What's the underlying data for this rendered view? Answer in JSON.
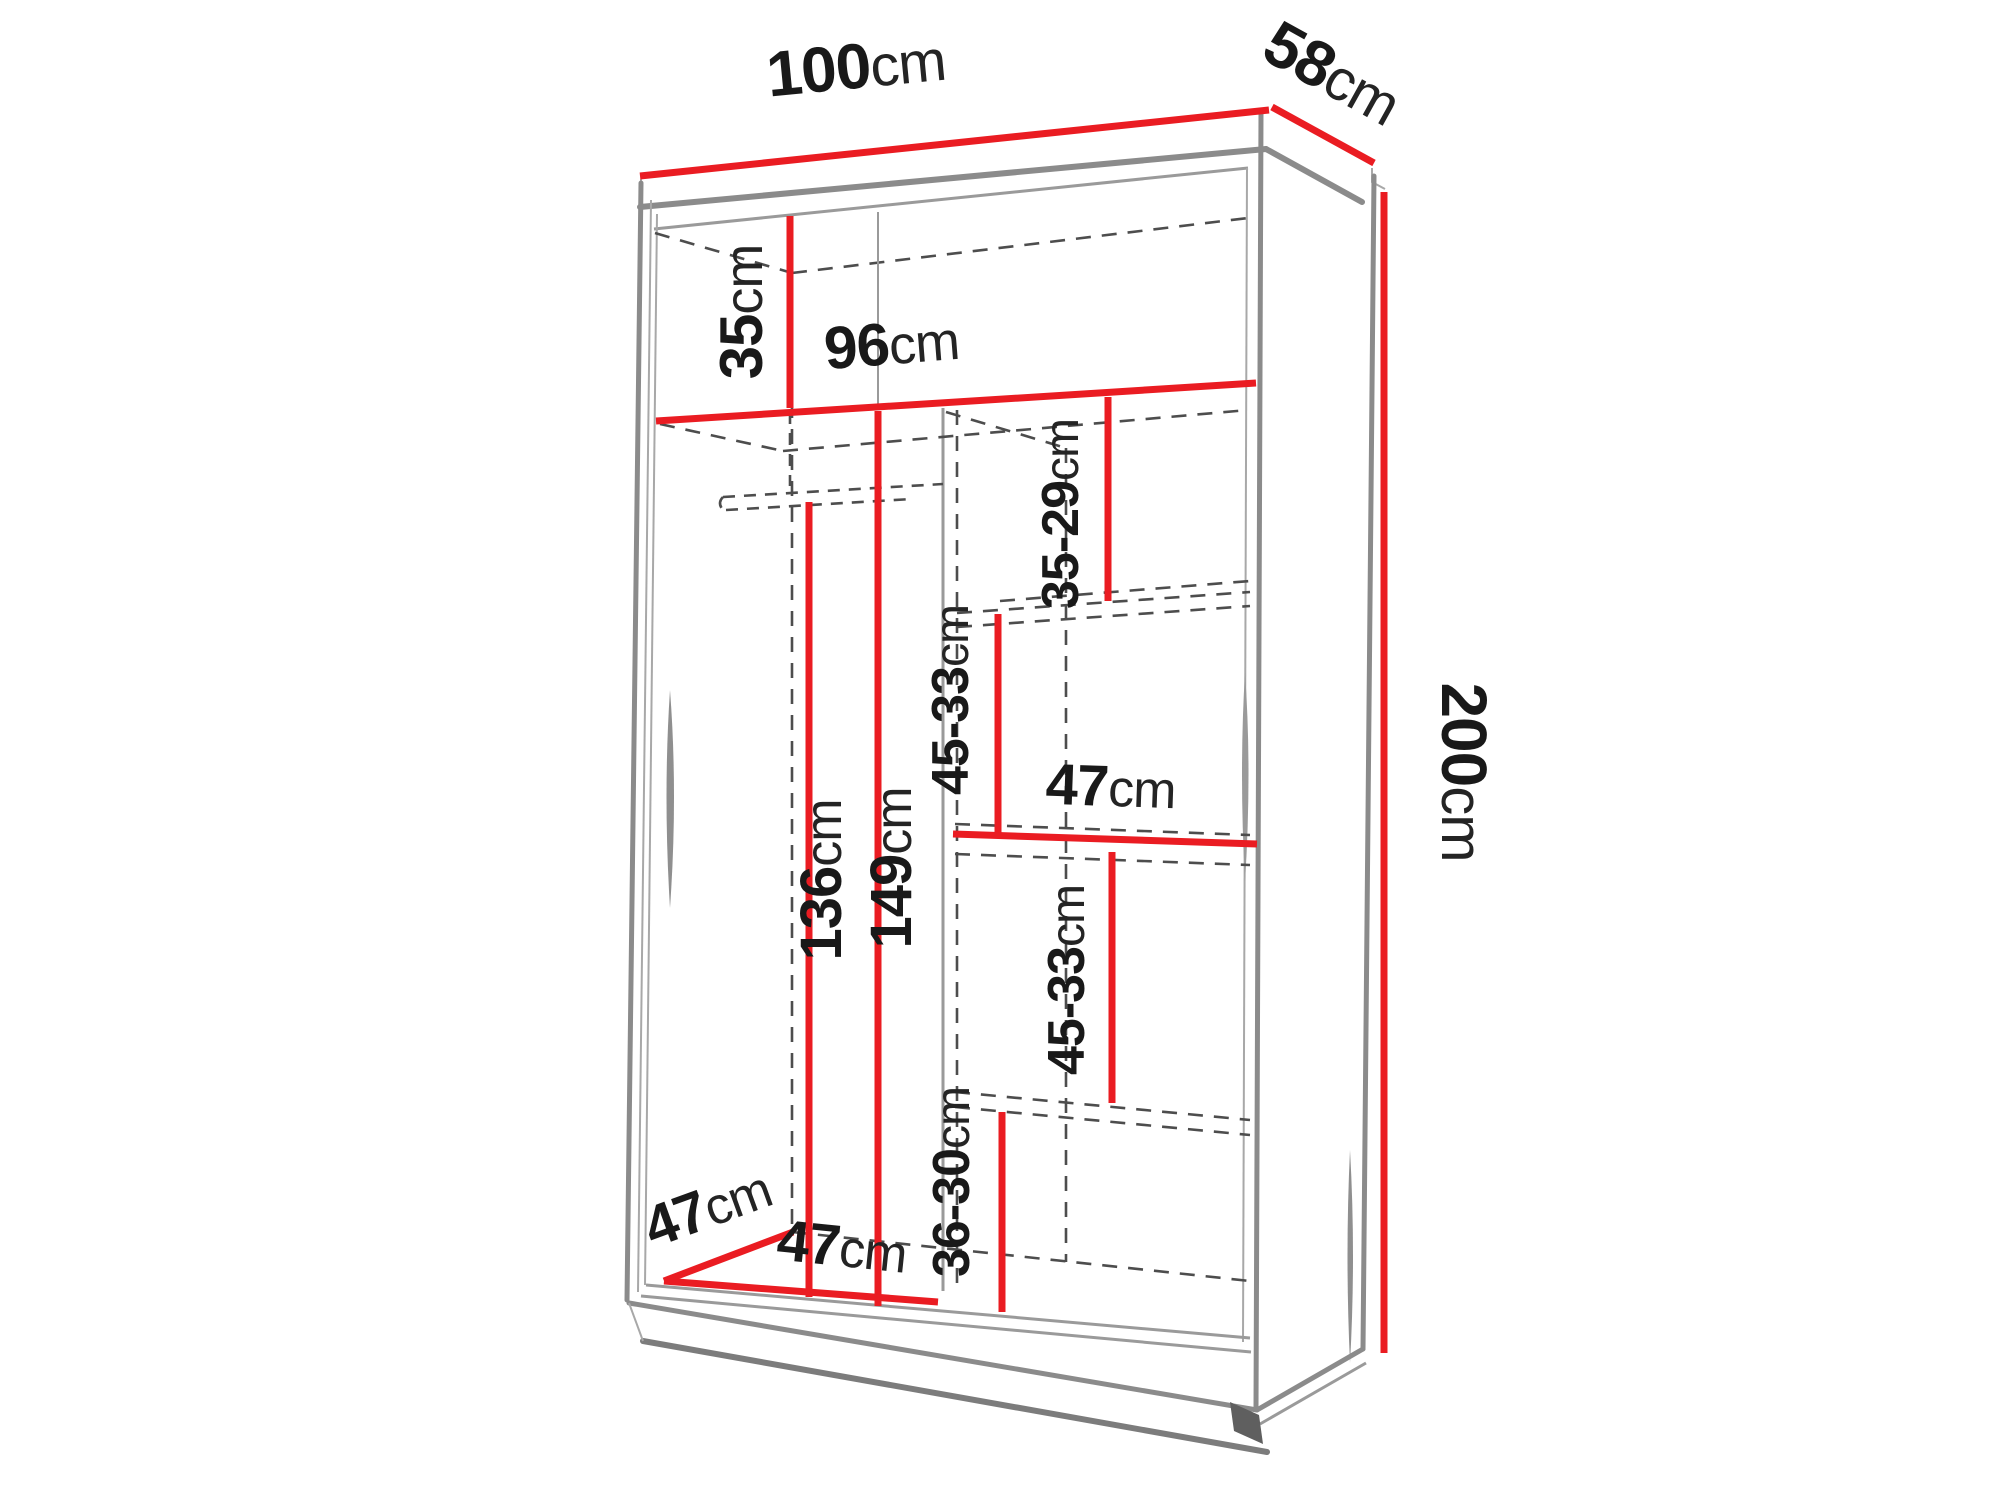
{
  "diagram": {
    "title": "wardrobe-dimension-diagram",
    "unit": "cm",
    "colors": {
      "dimension_line_red": "#ea1c22",
      "outline_gray": "#8b8b8b",
      "dashed_gray": "#4d4d4d",
      "label_text": "#191919",
      "background": "#ffffff"
    },
    "dimensions": {
      "width": {
        "value": "100",
        "unit": "cm"
      },
      "depth": {
        "value": "58",
        "unit": "cm"
      },
      "height": {
        "value": "200",
        "unit": "cm"
      },
      "top_shelf_height": {
        "value": "35",
        "unit": "cm"
      },
      "interior_width": {
        "value": "96",
        "unit": "cm"
      },
      "upper_right_shelf_gap": {
        "value": "35-29",
        "unit": "cm"
      },
      "mid_right_shelf_gap": {
        "value": "45-33",
        "unit": "cm"
      },
      "right_shelf_width": {
        "value": "47",
        "unit": "cm"
      },
      "hanging_clearance": {
        "value": "136",
        "unit": "cm"
      },
      "left_section_height": {
        "value": "149",
        "unit": "cm"
      },
      "lower_right_shelf_gap": {
        "value": "45-33",
        "unit": "cm"
      },
      "bottom_right_shelf_gap": {
        "value": "36-30",
        "unit": "cm"
      },
      "interior_depth": {
        "value": "47",
        "unit": "cm"
      },
      "left_section_width": {
        "value": "47",
        "unit": "cm"
      }
    }
  }
}
